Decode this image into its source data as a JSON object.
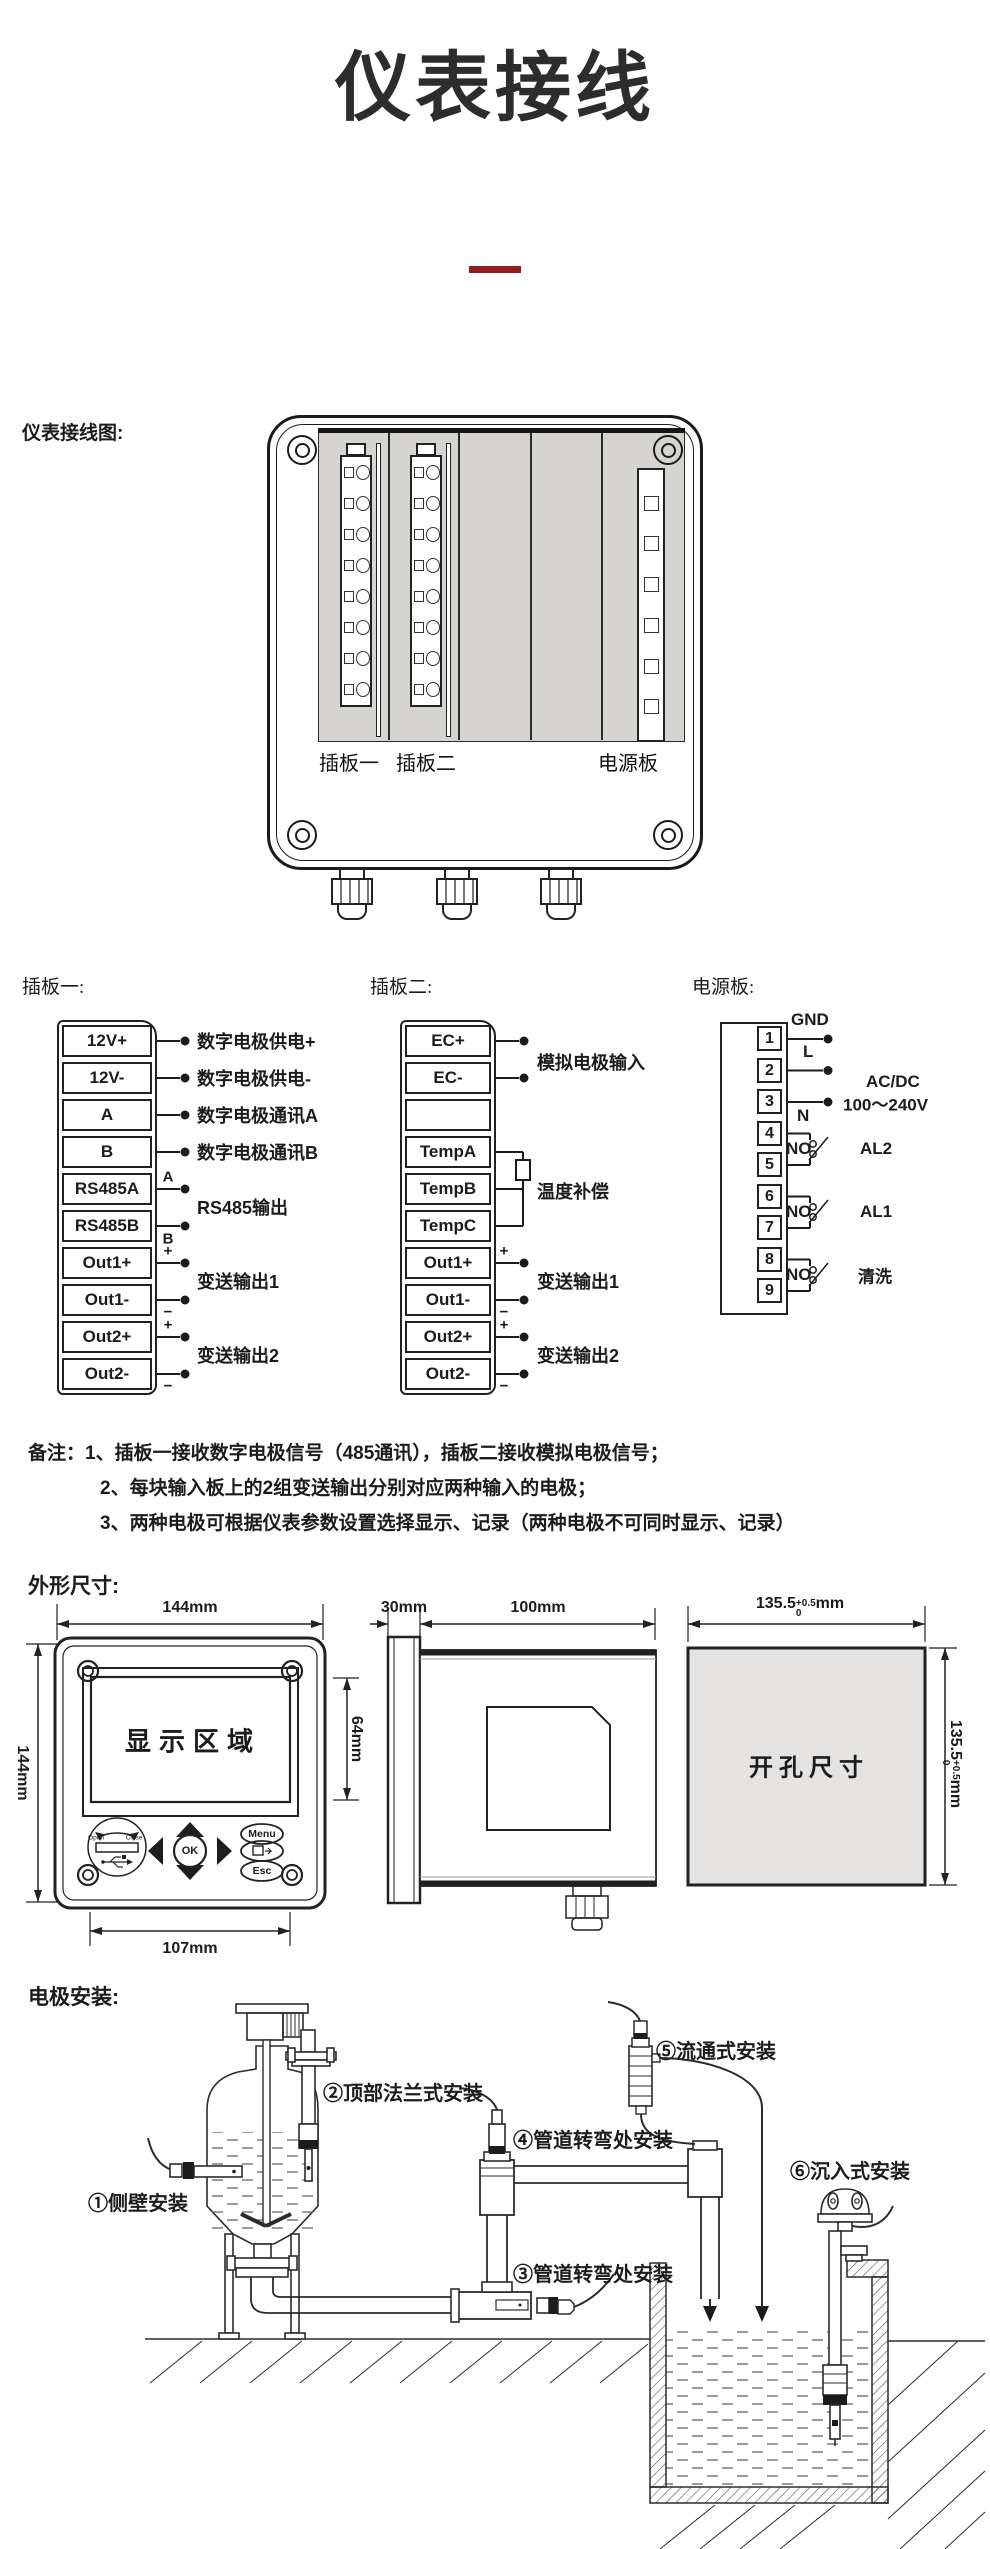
{
  "page": {
    "title": "仪表接线"
  },
  "wiring": {
    "heading": "仪表接线图:",
    "board1_label": "插板一",
    "board2_label": "插板二",
    "power_label": "电源板"
  },
  "board1": {
    "heading": "插板一:",
    "terminals": [
      "12V+",
      "12V-",
      "A",
      "B",
      "RS485A",
      "RS485B",
      "Out1+",
      "Out1-",
      "Out2+",
      "Out2-"
    ],
    "wire_labels": [
      "数字电极供电+",
      "数字电极供电-",
      "数字电极通讯A",
      "数字电极通讯B"
    ],
    "group_labels": [
      "RS485输出",
      "变送输出1",
      "变送输出2"
    ],
    "marks": {
      "a": "A",
      "b": "B",
      "plus": "+",
      "minus": "−"
    }
  },
  "board2": {
    "heading": "插板二:",
    "terminals": [
      "EC+",
      "EC-",
      "",
      "TempA",
      "TempB",
      "TempC",
      "Out1+",
      "Out1-",
      "Out2+",
      "Out2-"
    ],
    "labels": {
      "analog": "模拟电极输入",
      "temp": "温度补偿",
      "out1": "变送输出1",
      "out2": "变送输出2"
    },
    "marks": {
      "plus": "+",
      "minus": "−"
    }
  },
  "power": {
    "heading": "电源板:",
    "terminals": [
      "1",
      "2",
      "3",
      "4",
      "5",
      "6",
      "7",
      "8",
      "9"
    ],
    "labels": {
      "gnd": "GND",
      "l": "L",
      "n": "N",
      "acdc_line1": "AC/DC",
      "acdc_line2": "100～240V",
      "no": "NO",
      "al2": "AL2",
      "al1": "AL1",
      "clean": "清洗"
    }
  },
  "notes": {
    "prefix": "备注：",
    "items": [
      "1、插板一接收数字电极信号（485通讯），插板二接收模拟电极信号；",
      "2、每块输入板上的2组变送输出分别对应两种输入的电极；",
      "3、两种电极可根据仪表参数设置选择显示、记录（两种电极不可同时显示、记录）"
    ]
  },
  "dims": {
    "heading": "外形尺寸:",
    "front": {
      "width": "144mm",
      "height": "144mm",
      "mount": "107mm",
      "display_area": "显示区域",
      "display_height": "64mm",
      "open": "Open",
      "close": "Close",
      "ok": "OK",
      "menu": "Menu",
      "esc": "Esc"
    },
    "side": {
      "bezel": "30mm",
      "depth": "100mm"
    },
    "cutout": {
      "label": "开孔尺寸",
      "value": "135.5",
      "tol_upper": "+0.5",
      "tol_lower": "0",
      "unit": "mm"
    }
  },
  "install": {
    "heading": "电极安装:",
    "labels": [
      "①侧壁安装",
      "②顶部法兰式安装",
      "③管道转弯处安装",
      "④管道转弯处安装",
      "⑤流通式安装",
      "⑥沉入式安装"
    ]
  }
}
